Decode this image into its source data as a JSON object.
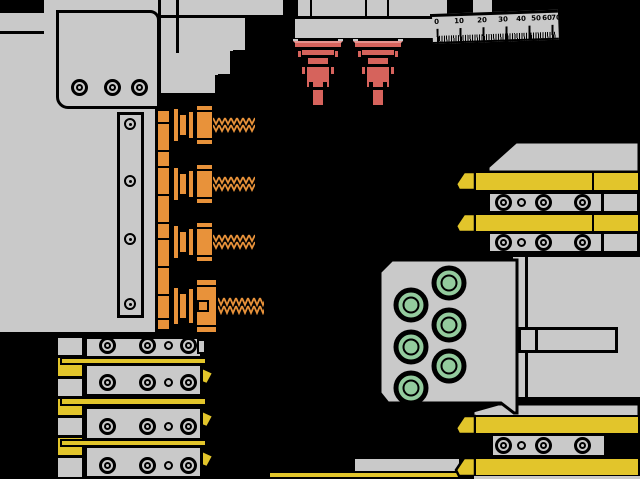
{
  "colors": {
    "background": "#000000",
    "gray": "#c9c9c9",
    "line": "#000000",
    "orange": "#e8923a",
    "yellow": "#e2c52b",
    "red": "#d6635c",
    "red_light": "#e5938e",
    "green": "#93cb9d",
    "seam": "#8a8a8a"
  },
  "ruler": {
    "labels": [
      "0",
      "10",
      "20",
      "30",
      "40",
      "50",
      "60",
      "70"
    ]
  }
}
